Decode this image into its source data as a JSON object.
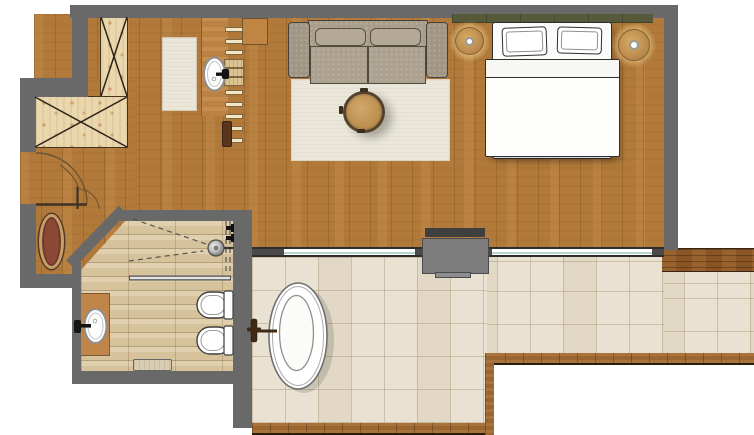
{
  "meta": {
    "title": "Hotel suite floor plan",
    "type": "architectural-floor-plan-top-view",
    "rooms": [
      "living-bedroom",
      "dressing-area",
      "bathroom",
      "entry",
      "terrace"
    ]
  },
  "palette": {
    "wall": "#696969",
    "wood_floor": "#b27a3a",
    "bathroom_floor": "#d6c29b",
    "terrace_tile": "#e9e2d2",
    "wardrobe_wood": "#ead7ae",
    "headboard_green": "#565a3b",
    "fixture_white": "#ffffff",
    "entry_rug_red": "#8c4836",
    "deck_wood": "#8a5526"
  },
  "labels": {
    "plan": "Hotel suite floor plan",
    "wardrobe": "L-shaped walk-in wardrobe",
    "entry_door": "Entrance door",
    "bath_door": "Bathroom door",
    "entry_rug": "Entry mat",
    "dressing_rug": "Dressing area rug",
    "dressing_sink": "Vanity washbasin",
    "towel_shelf": "Towel shelf",
    "console": "Console shelf",
    "stool": "Bench",
    "shower": "Walk-in shower head",
    "shower_glass": "Shower glass screen",
    "grab_bar": "Towel rail",
    "toilet": "Toilet",
    "bidet": "Bidet",
    "bath_sink": "Washbasin",
    "bath_vanity": "Vanity unit",
    "bath_mat": "Bath mat",
    "sofa": "Two-seat sofa",
    "area_rug": "Area rug",
    "coffee_table": "Round coffee table",
    "bed": "Double bed",
    "pillow": "Pillow",
    "duvet": "Duvet",
    "headboard": "Headboard",
    "nightstand_left": "Bedside table with lamp",
    "nightstand_right": "Bedside table with lamp",
    "fireplace": "Fireplace unit",
    "sliding_door": "Sliding glass door",
    "terrace": "Terrace",
    "bathtub": "Freestanding oval bathtub",
    "tub_faucet": "Floor-mounted bath filler",
    "deck_edge": "Timber deck border"
  }
}
